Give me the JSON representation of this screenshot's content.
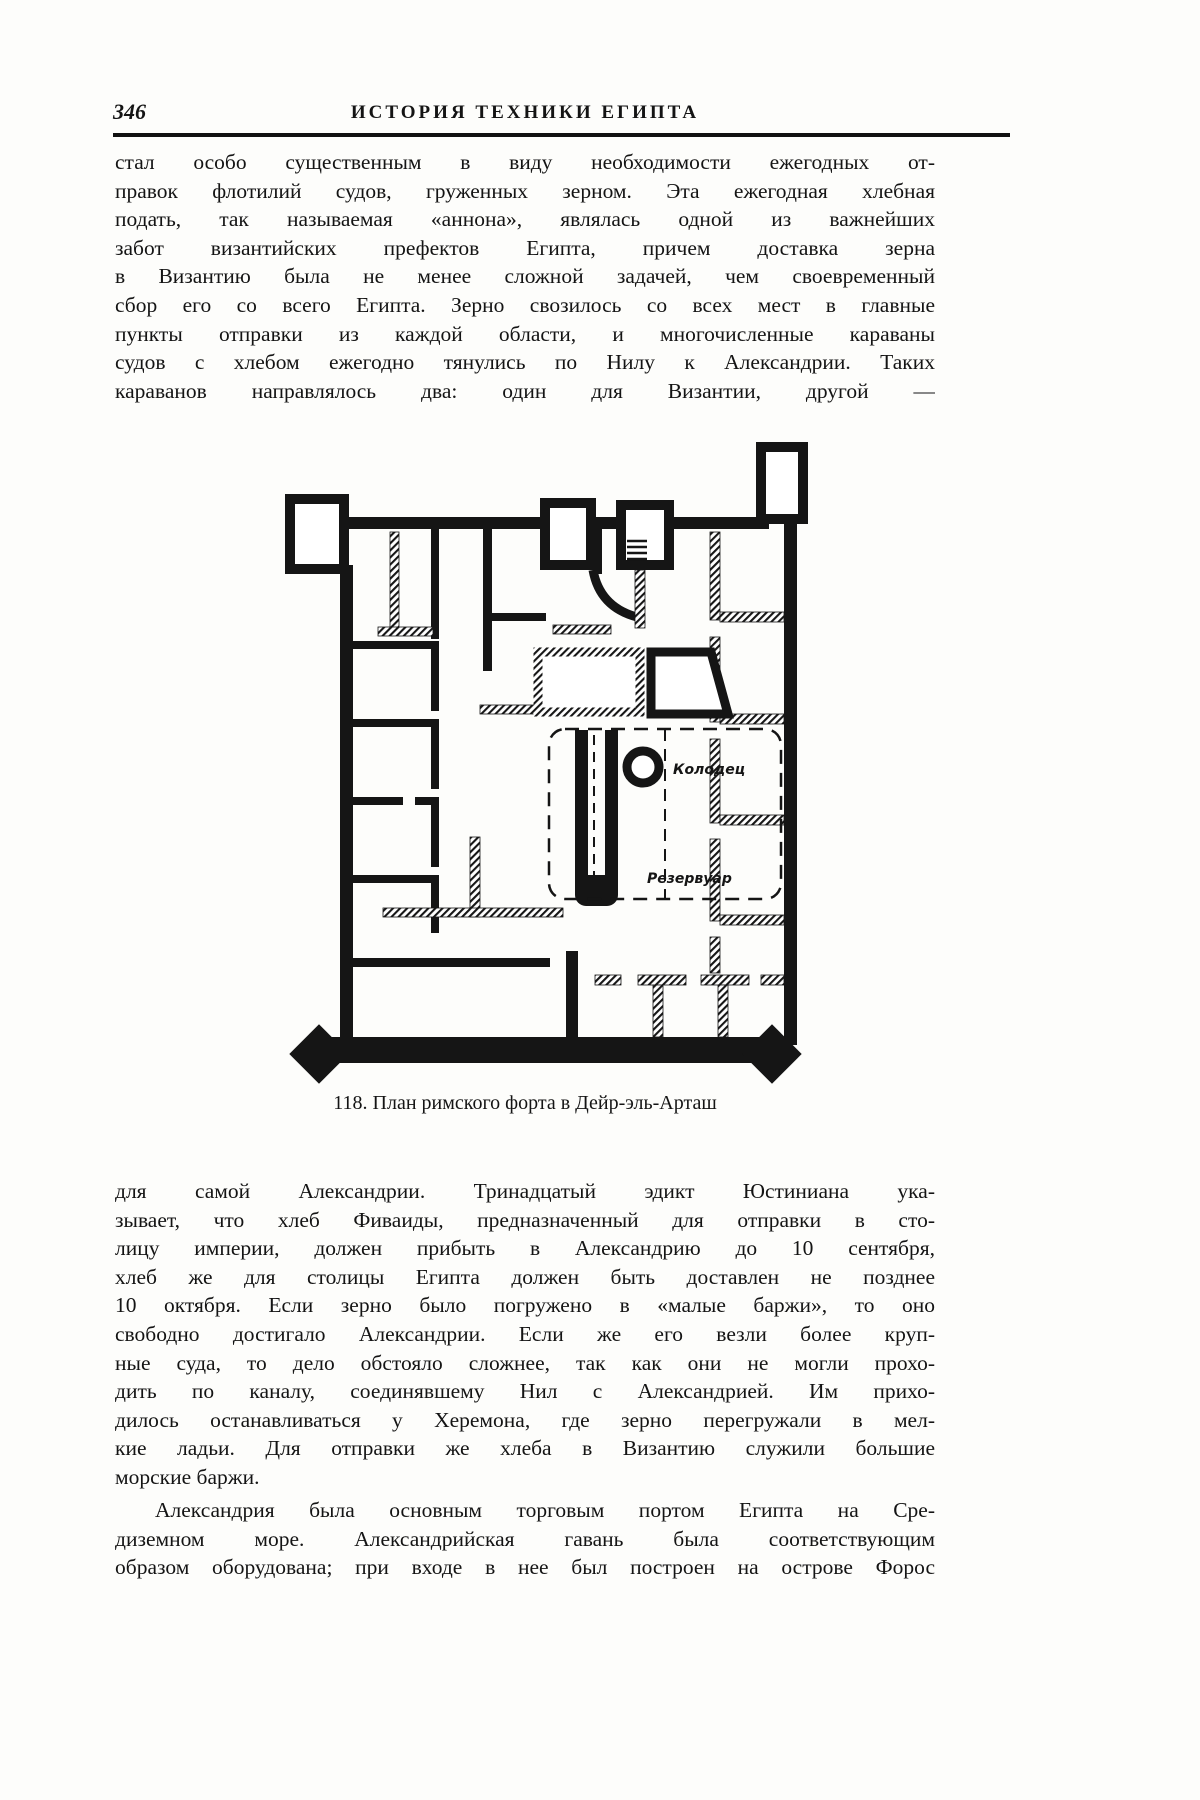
{
  "header": {
    "page_number": "346",
    "running_title": "ИСТОРИЯ ТЕХНИКИ ЕГИПТА"
  },
  "para1": {
    "lines": [
      "стал особо существенным в виду необходимости ежегодных от-",
      "правок флотилий судов, груженных зерном. Эта ежегодная хлебная",
      "подать, так называемая «аннона», являлась одной из важнейших",
      "забот византийских префектов Египта, причем доставка зерна",
      "в Византию была не менее сложной задачей, чем своевременный",
      "сбор его со всего Египта. Зерно свозилось со всех мест в главные",
      "пункты отправки из каждой области, и многочисленные караваны",
      "судов с хлебом ежегодно тянулись по Нилу к Александрии. Таких",
      "караванов направлялось два: один для Византии, другой —"
    ]
  },
  "figure": {
    "caption": "118. План римского форта в Дейр-эль-Арташ",
    "well_label": "Колодец",
    "reservoir_label": "Резервуар"
  },
  "para2": {
    "lines": [
      "для самой Александрии. Тринадцатый эдикт Юстиниана ука-",
      "зывает, что хлеб Фиваиды, предназначенный для отправки в сто-",
      "лицу империи, должен прибыть в Александрию до 10 сентября,",
      "хлеб же для столицы Египта должен быть доставлен не позднее",
      "10 октября. Если зерно было погружено в «малые баржи», то оно",
      "свободно достигало Александрии. Если же его везли более круп-",
      "ные суда, то дело обстояло сложнее, так как они не могли прохо-",
      "дить по каналу, соединявшему Нил с Александрией. Им прихо-",
      "дилось останавливаться у Херемона, где зерно перегружали в мел-",
      "кие ладьи. Для отправки же хлеба в Византию служили большие",
      "морские баржи."
    ]
  },
  "para3": {
    "lines": [
      "Александрия была основным торговым портом  Египта на Сре-",
      "диземном море. Александрийская  гавань была соответствующим",
      "образом оборудована; при входе в нее был построен на острове Форос"
    ]
  }
}
